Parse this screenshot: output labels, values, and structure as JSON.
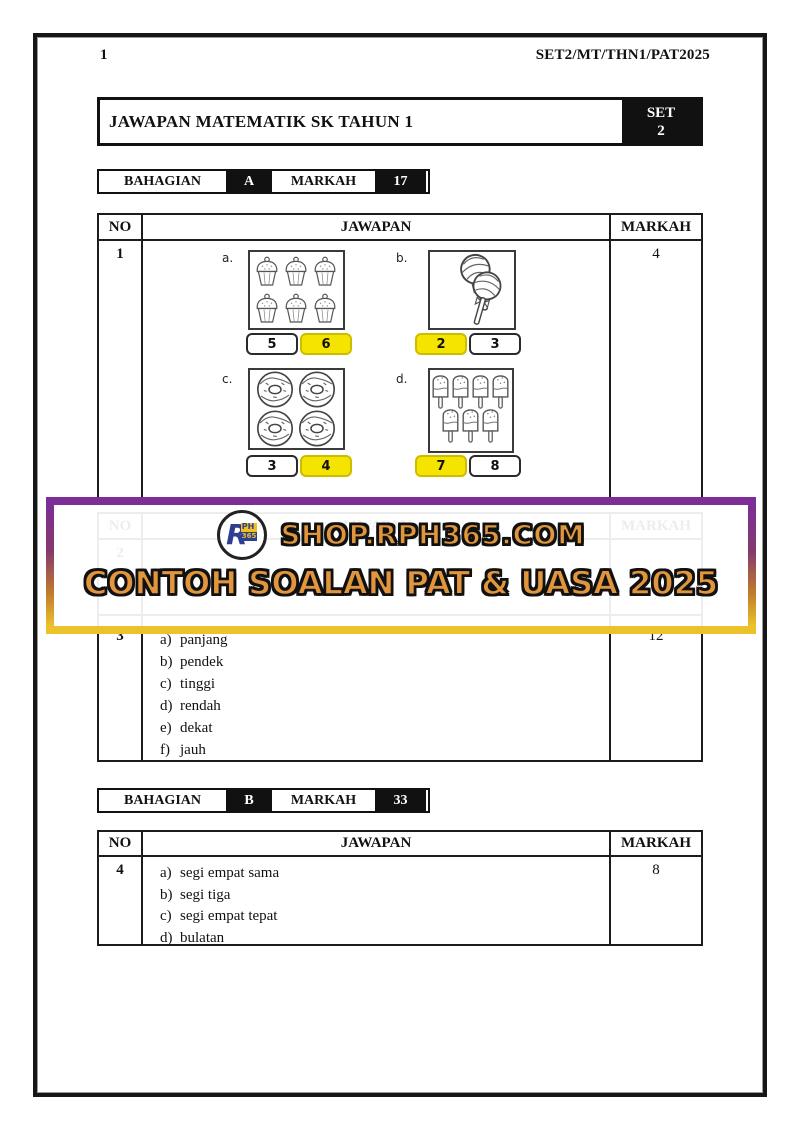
{
  "page": {
    "number": "1",
    "code": "SET2/MT/THN1/PAT2025"
  },
  "title_bar": {
    "title": "JAWAPAN MATEMATIK SK TAHUN 1",
    "set_top": "SET",
    "set_bottom": "2"
  },
  "section_a": {
    "label": "BAHAGIAN",
    "value": "A",
    "markah_label": "MARKAH",
    "markah_value": "17"
  },
  "section_b": {
    "label": "BAHAGIAN",
    "value": "B",
    "markah_label": "MARKAH",
    "markah_value": "33"
  },
  "table_header": {
    "no": "NO",
    "jawapan": "JAWAPAN",
    "markah": "MARKAH"
  },
  "q1": {
    "no": "1",
    "markah": "4",
    "groups": [
      {
        "label": "a.",
        "icon": "cupcake-icon",
        "count": 6,
        "options": [
          {
            "value": "5",
            "highlighted": false
          },
          {
            "value": "6",
            "highlighted": true
          }
        ]
      },
      {
        "label": "b.",
        "icon": "lollipop-icon",
        "count": 2,
        "options": [
          {
            "value": "2",
            "highlighted": true
          },
          {
            "value": "3",
            "highlighted": false
          }
        ]
      },
      {
        "label": "c.",
        "icon": "donut-icon",
        "count": 4,
        "options": [
          {
            "value": "3",
            "highlighted": false
          },
          {
            "value": "4",
            "highlighted": true
          }
        ]
      },
      {
        "label": "d.",
        "icon": "ice-pop-icon",
        "count": 7,
        "options": [
          {
            "value": "7",
            "highlighted": true
          },
          {
            "value": "8",
            "highlighted": false
          }
        ]
      }
    ]
  },
  "hidden_row": {
    "no": "2"
  },
  "q3": {
    "no": "3",
    "markah": "12",
    "items": [
      {
        "k": "a)",
        "t": "panjang"
      },
      {
        "k": "b)",
        "t": "pendek"
      },
      {
        "k": "c)",
        "t": "tinggi"
      },
      {
        "k": "d)",
        "t": "rendah"
      },
      {
        "k": "e)",
        "t": "dekat"
      },
      {
        "k": "f)",
        "t": "jauh"
      }
    ]
  },
  "q4": {
    "no": "4",
    "markah": "8",
    "items": [
      {
        "k": "a)",
        "t": "segi empat sama"
      },
      {
        "k": "b)",
        "t": "segi tiga"
      },
      {
        "k": "c)",
        "t": "segi empat tepat"
      },
      {
        "k": "d)",
        "t": "bulatan"
      }
    ]
  },
  "banner": {
    "shop_text": "SHOP.RPH365.COM",
    "tagline": "CONTOH SOALAN PAT & UASA 2025",
    "logo": {
      "r": "R",
      "ph": "PH",
      "n365": "365"
    }
  },
  "colors": {
    "highlight_yellow": "#F5E400",
    "banner_purple": "#7C2E96",
    "banner_gold": "#ECC32C",
    "bubble_orange": "#E1953C",
    "logo_blue": "#2E3F92",
    "logo_yellow": "#F0C020"
  }
}
